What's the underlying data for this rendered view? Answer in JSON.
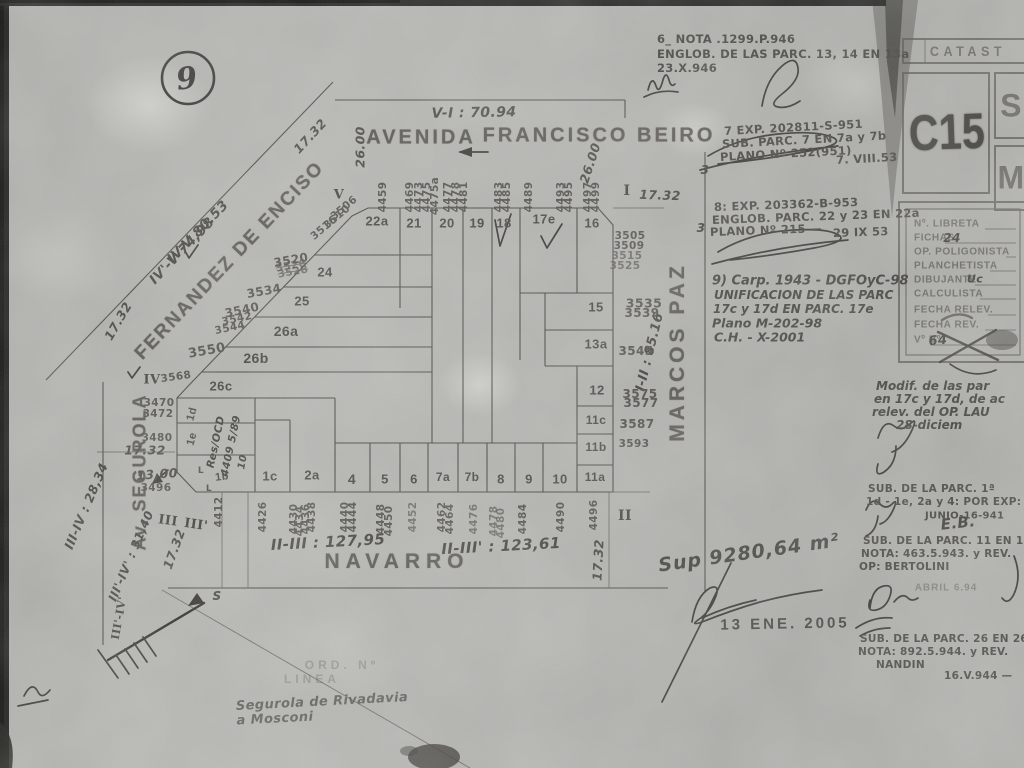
{
  "corner_circle": "9",
  "top_note": {
    "l1": "6_ NOTA .1299.P.946",
    "l2": "ENGLOB. DE LAS PARC. 13, 14 EN 13a",
    "l3": "23.X.946"
  },
  "catastro_card": {
    "header": "CATAST",
    "code": "C15",
    "box1": "S",
    "box2": "M"
  },
  "register_card": {
    "rows": [
      {
        "label": "Nº. LIBRETA",
        "value": ""
      },
      {
        "label": "FICHAS",
        "value": "24"
      },
      {
        "label": "OP. POLIGONISTA",
        "value": ""
      },
      {
        "label": "PLANCHETISTA",
        "value": ""
      },
      {
        "label": "DIBUJANTE",
        "value": "Uc"
      },
      {
        "label": "CALCULISTA",
        "value": ""
      },
      {
        "label": "FECHA RELEV.",
        "value": ""
      },
      {
        "label": "FECHA REV.",
        "value": ""
      },
      {
        "label": "Vº Bº",
        "value": "64"
      }
    ]
  },
  "streets": {
    "beiro1": "AVENIDA",
    "beiro2": "FRANCISCO BEIRO",
    "enciso": "FERNANDEZ DE ENCISO",
    "segurola": "Av. SEGUROLA",
    "navarro": "NAVARRO",
    "marcos_paz": "MARCOS PAZ"
  },
  "romans": {
    "v": "V",
    "i": "I",
    "ii": "II",
    "iii": "III",
    "iii2": "III'",
    "iv": "IV",
    "iii_iv": "III'-IV'"
  },
  "measurements": {
    "vi": "V-I : 70.94",
    "w26l": "26.00",
    "w26r": "26.00",
    "t1732a": "17.32",
    "t1732b": "17.32",
    "t1732c": "17.32",
    "t1732d": "17.32",
    "t1732e": "17.32",
    "t1732f": "17.32",
    "w1300": "13,00",
    "iii_85": "I-II : 85.16",
    "iiiii": "II-III : 127,95",
    "iiiii2": "II-III' : 123,61",
    "iiiiv": "III-IV : 28,34",
    "iiiiv2": "III'-IV' : 31,40",
    "ivv": "IV-V  80.53",
    "ivv2": "IV'-V  74,98"
  },
  "parcels": {
    "p22a": "22a",
    "p21": "21",
    "p20": "20",
    "p19": "19",
    "p18": "18",
    "p17e": "17e",
    "p16": "16",
    "p15": "15",
    "p13a": "13a",
    "p12": "12",
    "p11c": "11c",
    "p11b": "11b",
    "p11a": "11a",
    "p24": "24",
    "p25": "25",
    "p26a": "26a",
    "p26b": "26b",
    "p26c": "26c",
    "p1d": "1d",
    "p1e": "1e",
    "p1b": "1b",
    "p1c": "1c",
    "p2a": "2a",
    "p4": "4",
    "p5": "5",
    "p6": "6",
    "p7a": "7a",
    "p7b": "7b",
    "p8": "8",
    "p9": "9",
    "p10": "10"
  },
  "addresses": {
    "beiro": [
      "4459",
      "4469",
      "4473",
      "4475",
      "4475a",
      "4477",
      "4478",
      "4481",
      "4483",
      "4485",
      "4489",
      "4493",
      "4495",
      "4497",
      "4499"
    ],
    "marcos_paz": [
      "3505",
      "3509",
      "3515",
      "3525",
      "3535",
      "3539",
      "3545",
      "3575",
      "3577",
      "3587",
      "3593"
    ],
    "enciso": [
      "3506",
      "3510",
      "3516",
      "3520",
      "3526",
      "3528",
      "3534",
      "3540",
      "3542",
      "3544",
      "3550",
      "3568"
    ],
    "segurola": [
      "3470",
      "3472",
      "3480",
      "3496"
    ],
    "navarro": [
      "4412",
      "4426",
      "4430",
      "4434",
      "4436",
      "4438",
      "4440",
      "4444",
      "4448",
      "4450",
      "4452",
      "4462",
      "4464",
      "4476",
      "4478",
      "4480",
      "4484",
      "4490",
      "4496"
    ]
  },
  "notes": {
    "note7": [
      "7 EXP. 202811-S-951",
      "SUB. PARC. 7 EN 7a y 7b",
      "PLANO Nº 252(951)",
      "7. VIII.53"
    ],
    "note8": [
      "8: EXP. 203362-B-953",
      "ENGLOB. PARC. 22 y 23 EN 22a",
      "PLANO Nº 215 —",
      "29 IX 53"
    ],
    "note9": [
      "9) Carp. 1943 - DGFOyC-98",
      "UNIFICACION DE LAS PARC",
      "17c y 17d EN PARC. 17e",
      "Plano M-202-98",
      "C.H. - X-2001"
    ],
    "modif": [
      "Modif. de las par",
      "en 17c y 17d, de ac",
      "relev. del OP. LAU",
      "28-diciem"
    ],
    "sub1": [
      "SUB. DE LA PARC. 1ª",
      "1d - 1e, 2a y 4: POR EXP:",
      "JUNIO-16-941"
    ],
    "sub11": [
      "SUB. DE LA PARC. 11 EN 11ª",
      "NOTA: 463.5.943. y REV.",
      "OP: BERTOLINI"
    ],
    "sub26": [
      "SUB. DE LA PARC. 26 EN 26",
      "NOTA: 892.5.944. y REV.",
      "NANDIN",
      "16.V.944 —"
    ],
    "stray3": "3"
  },
  "handwriting": {
    "sup": "Sup 9280,64 m²",
    "eb": "E.B.",
    "res1": "Res/OCD",
    "res2": "4409 5/89",
    "res3": "10",
    "seg1": "Segurola de Rivadavia",
    "seg2": "a Mosconi"
  },
  "stamps": {
    "date": "13 ENE. 2005",
    "abril": "ABRIL 6.94",
    "ord1": "ORD. Nº",
    "ord2": "LINEA"
  },
  "compass": {
    "label": "S"
  },
  "bench": "L"
}
